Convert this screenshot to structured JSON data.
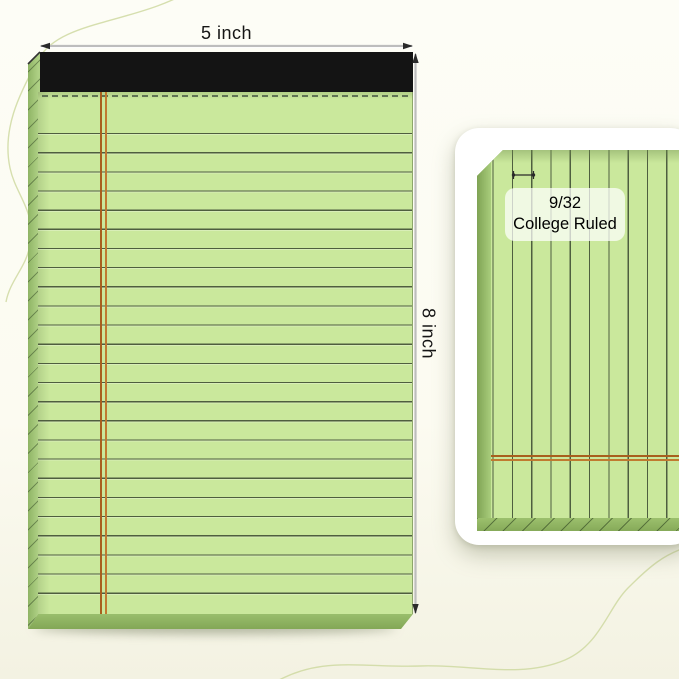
{
  "scene": {
    "width_dimension": {
      "label": "5 inch"
    },
    "height_dimension": {
      "label": "8 inch"
    },
    "detail_callout": {
      "line1": "9/32",
      "line2": "College Ruled"
    }
  },
  "colors": {
    "background": "#fdfdf6",
    "decor_curve": "#ccd79c",
    "paper_green": "#cae89c",
    "rule_line": "#4f5e44",
    "margin_line_dark": "#a8601e",
    "margin_line_light": "#c07a30",
    "binding_black": "#141414",
    "pad_edge_light": "#aed084",
    "pad_edge_dark": "#83a756",
    "dimension_line": "#bdbdbd",
    "dimension_arrow": "#2a2a2a",
    "label_text": "#151515",
    "card_background": "#ffffff",
    "callout_background": "rgba(255,255,255,0.72)"
  }
}
